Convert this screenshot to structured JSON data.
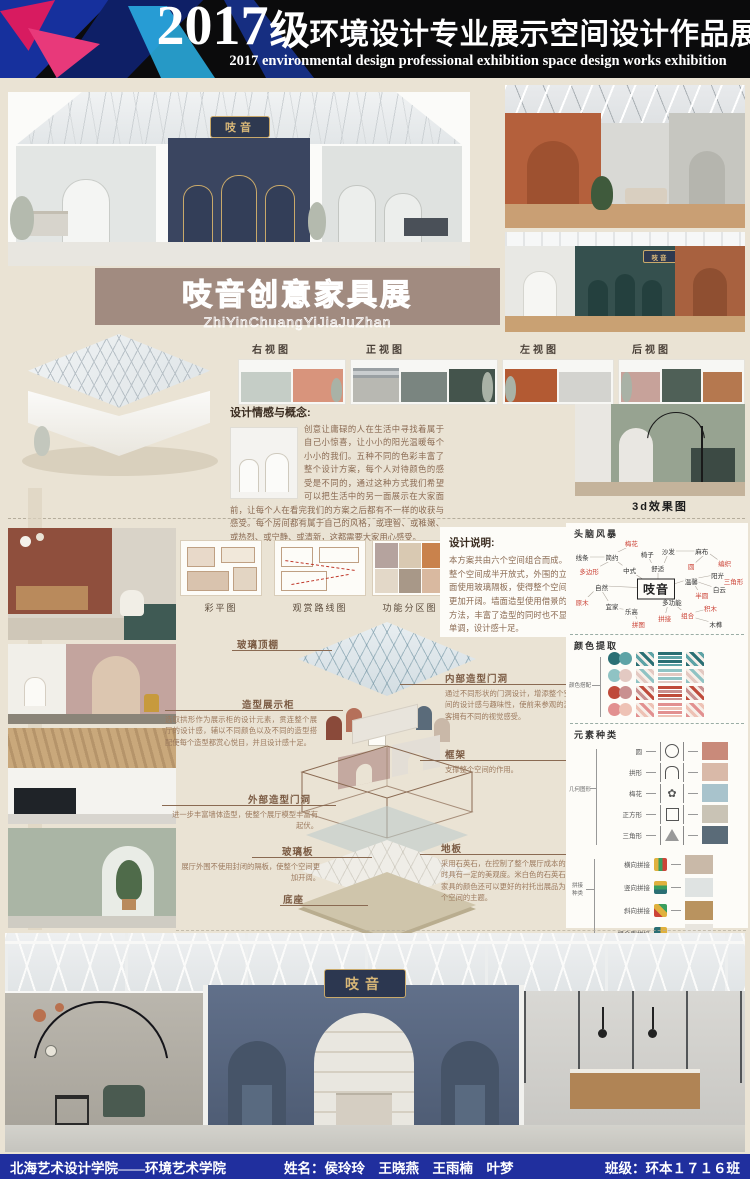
{
  "header": {
    "year": "2017",
    "grade_suffix": "级",
    "title_cn": "环境设计专业展示空间设计作品展",
    "subtitle_en": "2017 environmental design professional exhibition space design works exhibition"
  },
  "brand": {
    "name": "吱音",
    "sign_gold": "#d9b878"
  },
  "banner": {
    "title": "吱音创意家具展",
    "pinyin": "ZhiYinChuangYiJiaJuZhan",
    "bg": "#a18b80"
  },
  "views": {
    "labels": [
      "右视图",
      "正视图",
      "左视图",
      "后视图"
    ]
  },
  "concept": {
    "heading": "设计情感与概念:",
    "body": "创意让庸碌的人在生活中寻找着属于自己小惊喜，让小小的阳光温暖每个小小的我们。五种不同的色彩丰富了整个设计方案，每个人对待颜色的感受是不同的，通过这种方式我们希望可以把生活中的另一面展示在大家面前，让每个人在看完我们的方案之后都有不一样的收获与感受。每个房间都有属于自己的风格，或理智、或稚嫩、或热烈、或宁静、或清新，这都需要大家用心感受。"
  },
  "render3d": {
    "label": "3d效果图"
  },
  "design_note": {
    "heading": "设计说明:",
    "body": "本方案共由六个空间组合而成。整个空间成半开放式，外围的立面使用玻璃隔板，使得整个空间更加开阔。墙面造型使用借景的方法，丰富了造型的同时也不显单调，设计感十足。"
  },
  "plans": {
    "labels": [
      "彩平图",
      "观赏路线图",
      "功能分区图"
    ]
  },
  "exploded": {
    "glass_roof": "玻璃顶棚",
    "display_cabinet": "造型展示柜",
    "display_cabinet_note": "选取拱形作为展示柜的设计元素，贯连整个展厅的设计感，辅以不同颜色以及不同的造型搭配使每个造型都赏心悦目，并且设计感十足。",
    "outer_door": "外部造型门洞",
    "outer_door_note": "进一步丰富墙体造型，使整个展厅模型丰富有起伏。",
    "glass_panel": "玻璃板",
    "glass_panel_note": "展厅外围不使用封闭的隔板，使整个空间更加开阔。",
    "base": "底座",
    "inner_door": "内部造型门洞",
    "inner_door_note": "通过不同形状的门洞设计，增添整个空间的设计感与趣味性，使前来参观的游客拥有不同的视觉感受。",
    "frame": "框架",
    "frame_note": "支撑整个空间的作用。",
    "floor": "地板",
    "floor_note": "采用石英石，在控制了整个展厅成本的同时具有一定的美观度。米白色的石英石与家具的颜色还可以更好的衬托出展品为整个空间的主题。"
  },
  "brainstorm": {
    "heading": "头脑风暴",
    "center": "吱音",
    "nodes": [
      {
        "t": "梅花",
        "c": "r",
        "x": 36,
        "y": 5
      },
      {
        "t": "线条",
        "c": "k",
        "x": 8,
        "y": 21
      },
      {
        "t": "简约",
        "c": "k",
        "x": 25,
        "y": 21
      },
      {
        "t": "椅子",
        "c": "k",
        "x": 45,
        "y": 17
      },
      {
        "t": "沙发",
        "c": "k",
        "x": 57,
        "y": 14
      },
      {
        "t": "麻布",
        "c": "k",
        "x": 76,
        "y": 14
      },
      {
        "t": "编织",
        "c": "r",
        "x": 89,
        "y": 27
      },
      {
        "t": "圆",
        "c": "r",
        "x": 70,
        "y": 30
      },
      {
        "t": "多边形",
        "c": "r",
        "x": 12,
        "y": 36
      },
      {
        "t": "中式",
        "c": "k",
        "x": 35,
        "y": 35
      },
      {
        "t": "舒适",
        "c": "k",
        "x": 51,
        "y": 33
      },
      {
        "t": "阳光",
        "c": "k",
        "x": 85,
        "y": 40
      },
      {
        "t": "温馨",
        "c": "k",
        "x": 70,
        "y": 47
      },
      {
        "t": "白云",
        "c": "k",
        "x": 86,
        "y": 55
      },
      {
        "t": "三角形",
        "c": "r",
        "x": 94,
        "y": 47
      },
      {
        "t": "半圆",
        "c": "r",
        "x": 76,
        "y": 62
      },
      {
        "t": "自然",
        "c": "k",
        "x": 19,
        "y": 53
      },
      {
        "t": "原木",
        "c": "r",
        "x": 8,
        "y": 70
      },
      {
        "t": "宜家",
        "c": "k",
        "x": 25,
        "y": 74
      },
      {
        "t": "多功能",
        "c": "k",
        "x": 59,
        "y": 70
      },
      {
        "t": "乐高",
        "c": "k",
        "x": 36,
        "y": 79
      },
      {
        "t": "拼接",
        "c": "r",
        "x": 55,
        "y": 87
      },
      {
        "t": "组合",
        "c": "r",
        "x": 68,
        "y": 84
      },
      {
        "t": "拼图",
        "c": "r",
        "x": 40,
        "y": 93
      },
      {
        "t": "积木",
        "c": "r",
        "x": 81,
        "y": 76
      },
      {
        "t": "木榫",
        "c": "k",
        "x": 84,
        "y": 94
      }
    ]
  },
  "palette": {
    "heading": "颜色提取",
    "side_label": "颜色搭配",
    "rows": [
      {
        "c1": "#2a6f74",
        "c2": "#5da3a6"
      },
      {
        "c1": "#8fc3c4",
        "c2": "#e3c9c2"
      },
      {
        "c1": "#bf4a3a",
        "c2": "#c99090"
      },
      {
        "c1": "#e29090",
        "c2": "#eec2b5"
      }
    ]
  },
  "elements": {
    "heading": "元素种类",
    "group1_label": "几何图形",
    "shapes": [
      "圆",
      "拱形",
      "梅花",
      "正方形",
      "三角形"
    ],
    "group2_label": "拼接种类",
    "joins": [
      "横向拼接",
      "竖向拼接",
      "斜向拼接",
      "组合型拼接"
    ]
  },
  "footer": {
    "school": "北海艺术设计学院——环境艺术学院",
    "names": "姓名：侯玲玲　王晓燕　王雨楠　叶梦",
    "class": "班级：环本１７１６班",
    "bg": "#202f9e"
  }
}
